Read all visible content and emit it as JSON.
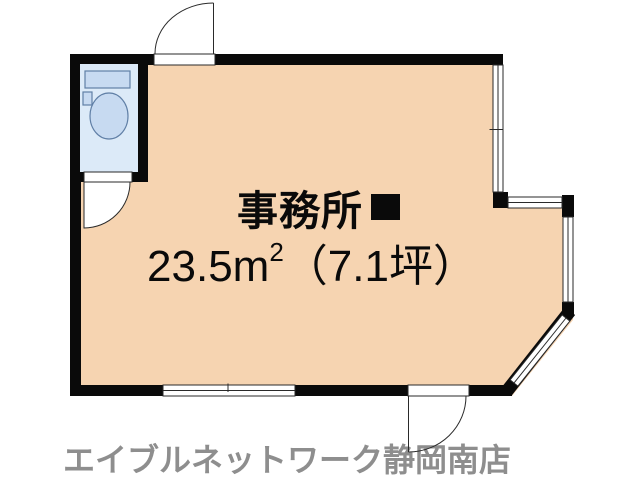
{
  "plan": {
    "room": {
      "name": "事務所",
      "marker": "■",
      "area_text_main": "23.5m",
      "area_text_sup": "2",
      "area_text_tsubo": "（7.1坪）"
    }
  },
  "footer": {
    "store_name": "エイブルネットワーク静岡南店"
  },
  "colors": {
    "room-fill": "#f6d4b1",
    "toilet-fill": "#dceaf8",
    "fixture-fill": "#c7daf1",
    "fixture-stroke": "#607fa6",
    "wall": "#0a0a0a",
    "line": "#2a2a2a",
    "text": "#0a0a0a",
    "footer-text": "#8e8e8e"
  }
}
